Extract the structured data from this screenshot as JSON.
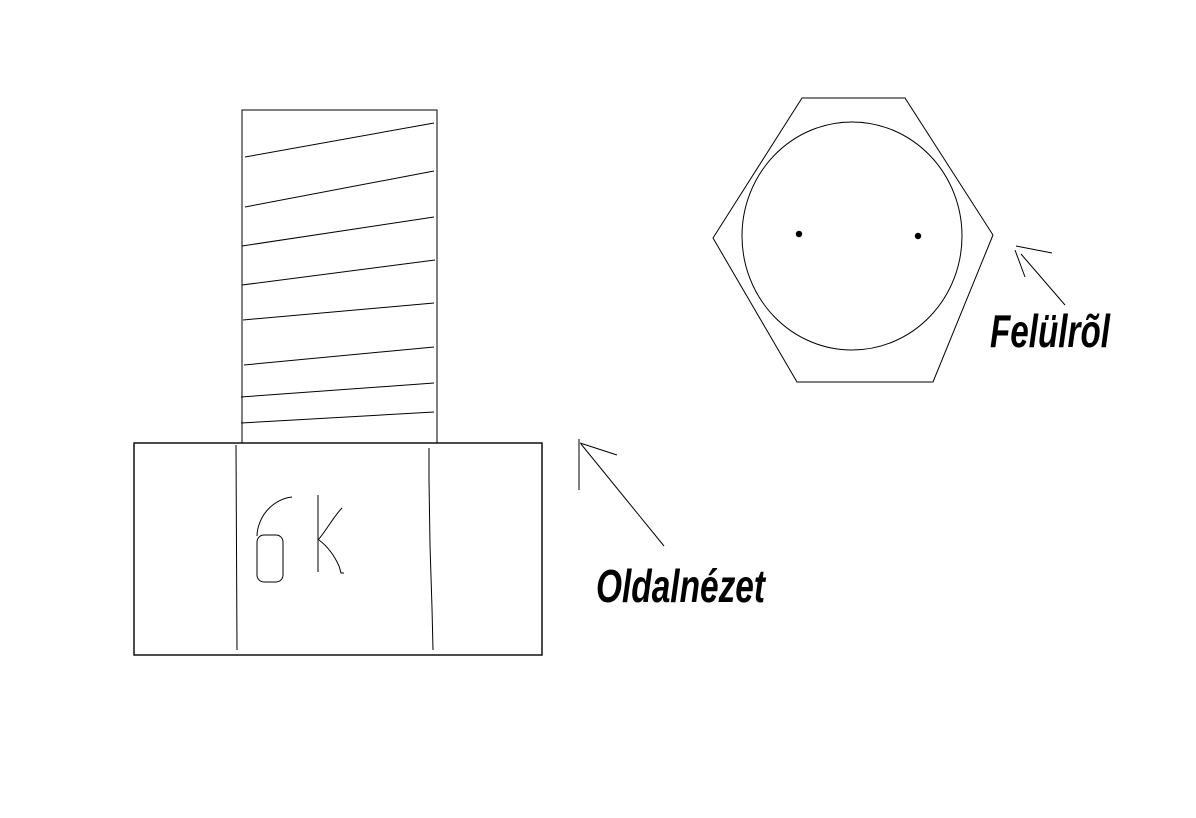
{
  "canvas": {
    "background": "#ffffff",
    "ink_color": "#000000",
    "description": "Hand-drawn sketch of a hexagonal-head bolt in two views"
  },
  "views": {
    "side": {
      "label": "Oldalnézet",
      "head_marking": "6K",
      "thread_line_count": 8
    },
    "top": {
      "label": "Felülrõl",
      "dot_count": 2
    }
  }
}
